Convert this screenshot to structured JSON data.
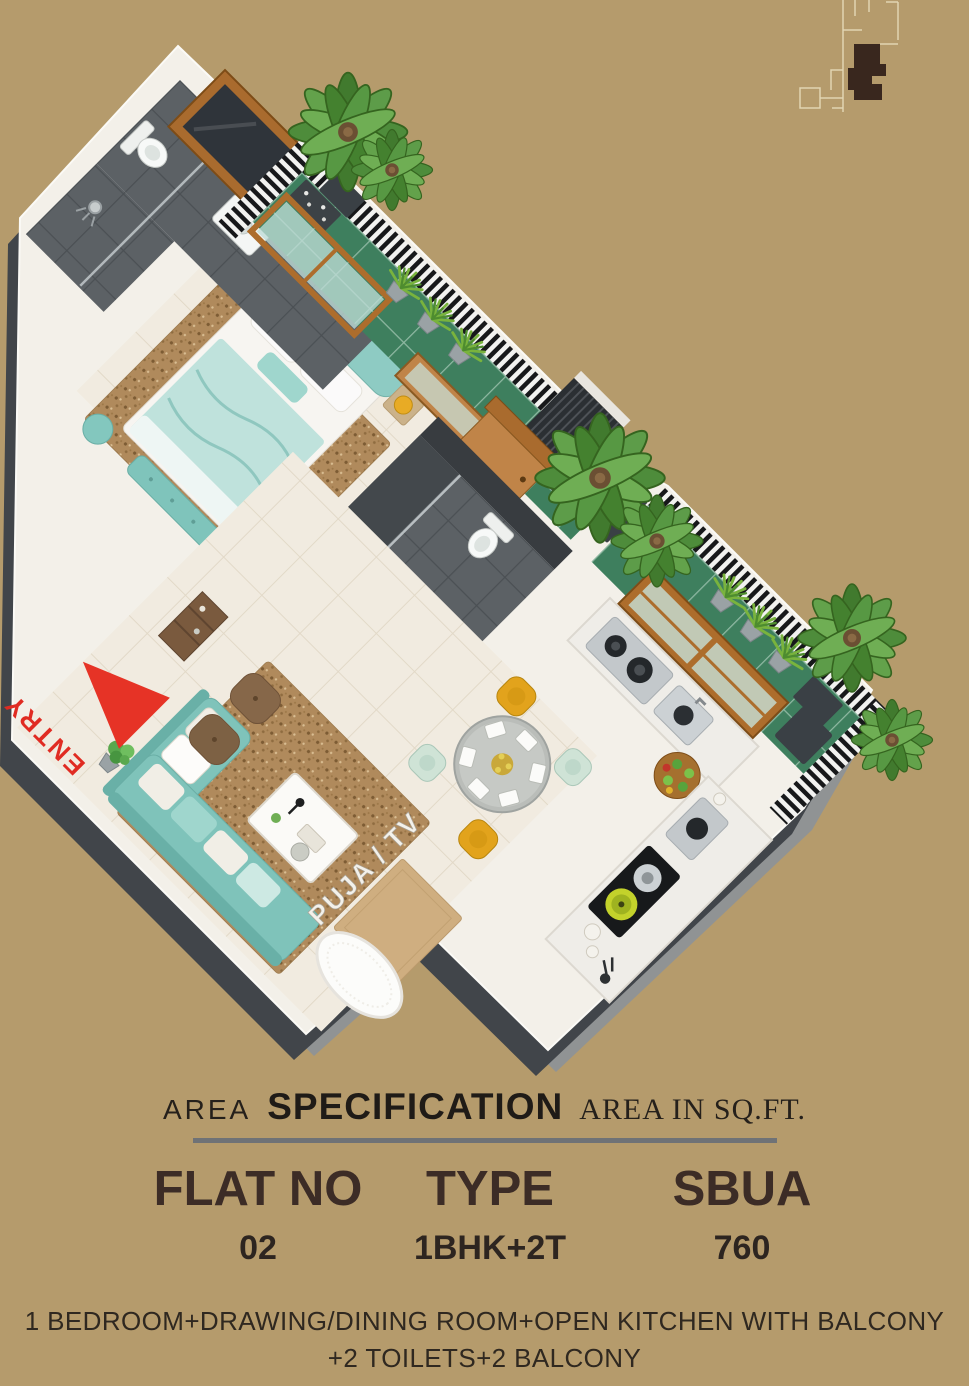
{
  "page": {
    "background": "#b59b6c",
    "width": 969,
    "height": 1386
  },
  "plan": {
    "entry_label": "ENTRY",
    "puja_tv_label": "PUJA / TV",
    "colors": {
      "slab_white": "#f3f0e9",
      "slab_side_dark": "#41454a",
      "slab_side_light": "#909394",
      "balcony_tile_green": "#3e7f5e",
      "bathroom_tile_grey": "#5c6165",
      "floor_cream": "#f1ebe0",
      "sofa_bed_teal": "#7fc3ba",
      "wood_brown": "#ad6d2c",
      "entry_red": "#e0342a",
      "lamp_yellow": "#e8ab25",
      "chair_yellow": "#e2a31c",
      "chair_mint": "#cfe3d6",
      "cooktop_lime": "#c3d22b",
      "railing_dark": "#17181a",
      "railing_light": "#f2f2f0"
    }
  },
  "spec": {
    "title_prefix": "AREA",
    "title_main": "SPECIFICATION",
    "title_suffix": "AREA IN SQ.FT.",
    "columns": [
      {
        "label": "FLAT NO",
        "value": "02"
      },
      {
        "label": "TYPE",
        "value": "1BHK+2T"
      },
      {
        "label": "SBUA",
        "value": "760"
      }
    ],
    "description_line1": "1 BEDROOM+DRAWING/DINING ROOM+OPEN KITCHEN WITH BALCONY",
    "description_line2": "+2 TOILETS+2 BALCONY"
  }
}
